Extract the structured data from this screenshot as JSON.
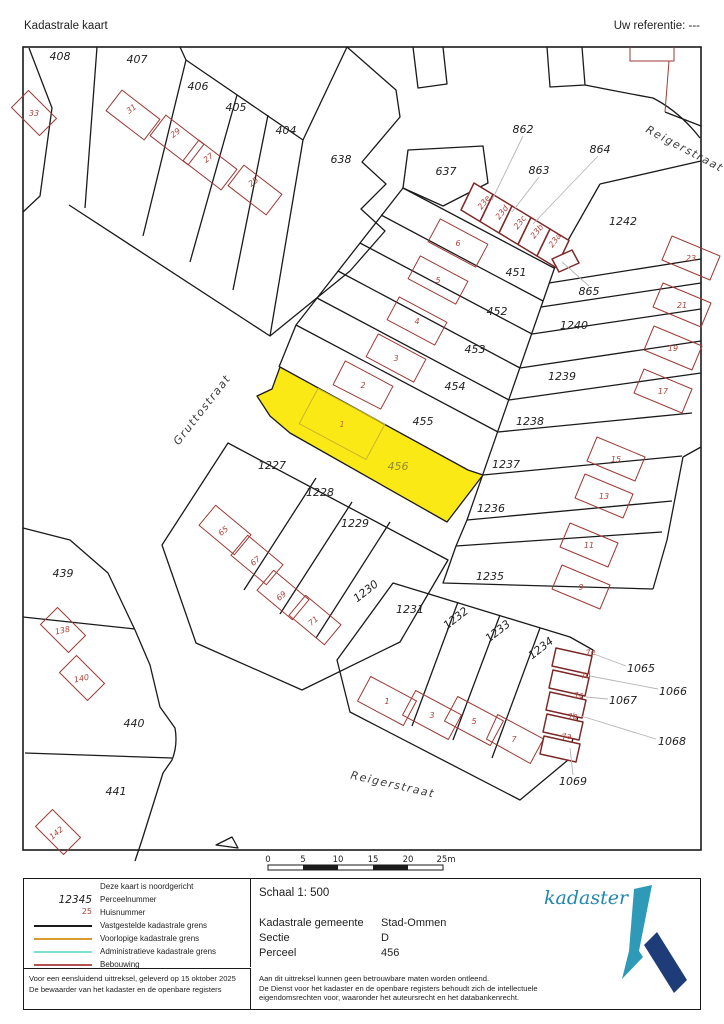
{
  "header": {
    "title": "Kadastrale kaart",
    "reference": "Uw referentie: ---"
  },
  "map": {
    "highlighted_parcel": "456",
    "highlight_color": "#fbe916",
    "street_labels": [
      {
        "t": "Gruttostraat",
        "x": 205,
        "y": 412,
        "a": -52
      },
      {
        "t": "Reigerstraat",
        "x": 683,
        "y": 152,
        "a": 28
      },
      {
        "t": "Reigerstraat",
        "x": 392,
        "y": 788,
        "a": 13
      }
    ],
    "parcel_labels": [
      {
        "t": "408",
        "x": 60,
        "y": 60
      },
      {
        "t": "407",
        "x": 137,
        "y": 63
      },
      {
        "t": "406",
        "x": 198,
        "y": 90
      },
      {
        "t": "405",
        "x": 236,
        "y": 111
      },
      {
        "t": "404",
        "x": 286,
        "y": 134
      },
      {
        "t": "638",
        "x": 341,
        "y": 163
      },
      {
        "t": "637",
        "x": 446,
        "y": 175
      },
      {
        "t": "862",
        "x": 523,
        "y": 133
      },
      {
        "t": "863",
        "x": 539,
        "y": 174
      },
      {
        "t": "864",
        "x": 600,
        "y": 153
      },
      {
        "t": "865",
        "x": 589,
        "y": 295
      },
      {
        "t": "451",
        "x": 516,
        "y": 276
      },
      {
        "t": "452",
        "x": 497,
        "y": 315
      },
      {
        "t": "453",
        "x": 475,
        "y": 353
      },
      {
        "t": "454",
        "x": 455,
        "y": 390
      },
      {
        "t": "455",
        "x": 423,
        "y": 425
      },
      {
        "t": "456",
        "x": 398,
        "y": 470,
        "cls": "olive"
      },
      {
        "t": "1242",
        "x": 623,
        "y": 225
      },
      {
        "t": "1240",
        "x": 574,
        "y": 329
      },
      {
        "t": "1239",
        "x": 562,
        "y": 380
      },
      {
        "t": "1238",
        "x": 530,
        "y": 425
      },
      {
        "t": "1237",
        "x": 506,
        "y": 468
      },
      {
        "t": "1236",
        "x": 491,
        "y": 512
      },
      {
        "t": "1235",
        "x": 490,
        "y": 580
      },
      {
        "t": "1227",
        "x": 272,
        "y": 469
      },
      {
        "t": "1228",
        "x": 320,
        "y": 496
      },
      {
        "t": "1229",
        "x": 355,
        "y": 527
      },
      {
        "t": "1230",
        "x": 368,
        "y": 594,
        "a": -38
      },
      {
        "t": "1231",
        "x": 410,
        "y": 613
      },
      {
        "t": "1232",
        "x": 458,
        "y": 621,
        "a": -38
      },
      {
        "t": "1233",
        "x": 500,
        "y": 634,
        "a": -38
      },
      {
        "t": "1234",
        "x": 543,
        "y": 651,
        "a": -38
      },
      {
        "t": "1065",
        "x": 641,
        "y": 672
      },
      {
        "t": "1066",
        "x": 673,
        "y": 695
      },
      {
        "t": "1067",
        "x": 623,
        "y": 704
      },
      {
        "t": "1068",
        "x": 672,
        "y": 745
      },
      {
        "t": "1069",
        "x": 573,
        "y": 785
      },
      {
        "t": "439",
        "x": 63,
        "y": 577
      },
      {
        "t": "440",
        "x": 134,
        "y": 727
      },
      {
        "t": "441",
        "x": 116,
        "y": 795
      }
    ],
    "house_labels": [
      {
        "t": "33",
        "x": 34,
        "y": 116
      },
      {
        "t": "31",
        "x": 133,
        "y": 111,
        "a": -38
      },
      {
        "t": "29",
        "x": 177,
        "y": 135,
        "a": -38
      },
      {
        "t": "27",
        "x": 210,
        "y": 160,
        "a": -38
      },
      {
        "t": "25",
        "x": 255,
        "y": 184,
        "a": -38
      },
      {
        "t": "23e",
        "x": 486,
        "y": 204,
        "a": -52
      },
      {
        "t": "23d",
        "x": 504,
        "y": 214,
        "a": -52
      },
      {
        "t": "23c",
        "x": 522,
        "y": 224,
        "a": -52
      },
      {
        "t": "23b",
        "x": 539,
        "y": 233,
        "a": -52
      },
      {
        "t": "23a",
        "x": 557,
        "y": 242,
        "a": -52
      },
      {
        "t": "6",
        "x": 458,
        "y": 246
      },
      {
        "t": "5",
        "x": 438,
        "y": 283
      },
      {
        "t": "4",
        "x": 417,
        "y": 324
      },
      {
        "t": "3",
        "x": 396,
        "y": 361
      },
      {
        "t": "2",
        "x": 363,
        "y": 388
      },
      {
        "t": "1",
        "x": 342,
        "y": 427,
        "cls": "muted"
      },
      {
        "t": "23",
        "x": 691,
        "y": 261
      },
      {
        "t": "21",
        "x": 682,
        "y": 308
      },
      {
        "t": "19",
        "x": 673,
        "y": 351
      },
      {
        "t": "17",
        "x": 663,
        "y": 394
      },
      {
        "t": "15",
        "x": 616,
        "y": 462
      },
      {
        "t": "13",
        "x": 604,
        "y": 499
      },
      {
        "t": "11",
        "x": 589,
        "y": 548
      },
      {
        "t": "9",
        "x": 581,
        "y": 590
      },
      {
        "t": "65",
        "x": 225,
        "y": 533,
        "a": -40
      },
      {
        "t": "67",
        "x": 257,
        "y": 563,
        "a": -40
      },
      {
        "t": "69",
        "x": 283,
        "y": 598,
        "a": -40
      },
      {
        "t": "71",
        "x": 315,
        "y": 623,
        "a": -40
      },
      {
        "t": "138",
        "x": 63,
        "y": 633,
        "a": -12
      },
      {
        "t": "140",
        "x": 82,
        "y": 681,
        "a": -12
      },
      {
        "t": "142",
        "x": 58,
        "y": 835,
        "a": -40
      },
      {
        "t": "1",
        "x": 387,
        "y": 704
      },
      {
        "t": "3",
        "x": 432,
        "y": 718
      },
      {
        "t": "5",
        "x": 474,
        "y": 724
      },
      {
        "t": "7",
        "x": 514,
        "y": 742
      },
      {
        "t": "7e",
        "x": 591,
        "y": 655,
        "a": -8
      },
      {
        "t": "7d",
        "x": 586,
        "y": 678,
        "a": -8
      },
      {
        "t": "7c",
        "x": 579,
        "y": 698,
        "a": -8
      },
      {
        "t": "7b",
        "x": 573,
        "y": 719,
        "a": -8
      },
      {
        "t": "7a",
        "x": 567,
        "y": 739,
        "a": -8
      }
    ]
  },
  "scale_bar": {
    "ticks": [
      "0",
      "5",
      "10",
      "15",
      "20",
      "25m"
    ]
  },
  "legend": {
    "items": [
      {
        "symbol": "none",
        "label": "Deze kaart is noordgericht"
      },
      {
        "symbol": "parcel-sample",
        "sample": "12345",
        "label": "Perceelnummer"
      },
      {
        "symbol": "house-sample",
        "sample": "25",
        "label": "Huisnummer",
        "color": "#b0423a"
      },
      {
        "symbol": "line",
        "color": "#1a1a1a",
        "label": "Vastgestelde kadastrale grens"
      },
      {
        "symbol": "line",
        "color": "#d79b2f",
        "label": "Voorlopige kadastrale grens"
      },
      {
        "symbol": "line",
        "color": "#7ce0d3",
        "label": "Administratieve kadastrale grens"
      },
      {
        "symbol": "line",
        "color": "#b05252",
        "label": "Bebouwing"
      }
    ]
  },
  "certificate": {
    "line1": "Voor een eensluidend uittreksel, geleverd op 15 oktober 2025",
    "line2": "De bewaarder van het kadaster en de openbare registers"
  },
  "details": {
    "scale_label": "Schaal 1: 500",
    "rows": [
      {
        "label": "Kadastrale gemeente",
        "value": "Stad-Ommen"
      },
      {
        "label": "Sectie",
        "value": "D"
      },
      {
        "label": "Perceel",
        "value": "456"
      }
    ],
    "disclaimer": [
      "Aan dit uittreksel kunnen geen betrouwbare maten worden ontleend.",
      "De Dienst voor het kadaster en de openbare registers behoudt zich de intellectuele",
      "eigendomsrechten voor, waaronder het auteursrecht en het databankenrecht."
    ]
  },
  "logo": {
    "text": "kadaster",
    "text_color": "#2187ad",
    "light_color": "#2e9ab8",
    "dark_color": "#1d3c78"
  }
}
